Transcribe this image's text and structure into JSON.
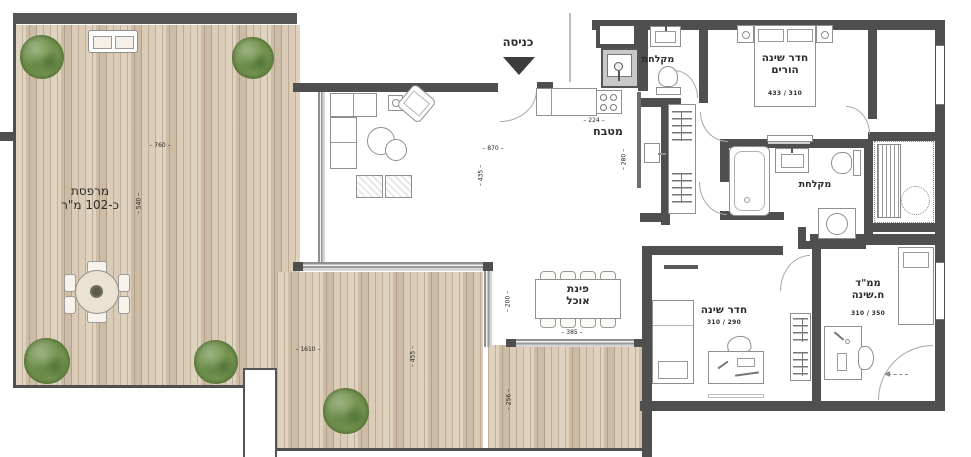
{
  "texts": {
    "entrance": "כניסה",
    "terrace_name": "מרפסת",
    "terrace_area": "כ-102 מ\"ר",
    "kitchen": "מטבח",
    "dining_line1": "פינת",
    "dining_line2": "אוכל",
    "master_line1": "חדר שינה",
    "master_line2": "הורים",
    "master_size": "433 / 310",
    "shower_entry": "מקלחת",
    "shower_master": "מקלחת",
    "bedroom2": "חדר שינה",
    "bedroom2_size": "310 / 290",
    "mamad_line1": "ממ\"ד",
    "mamad_line2": "ח.שינה",
    "mamad_size": "310 / 350"
  },
  "dims": {
    "terrace_w": "760",
    "terrace_h": "540",
    "living_w": "870",
    "living_h": "435",
    "kitchen_w": "224",
    "kitchen_h": "280",
    "deck_w": "1610",
    "deck_h": "455",
    "deck_h2": "256",
    "dining_side": "200",
    "dining_w": "385"
  },
  "colors": {
    "deck_wood": "#d9c9b3",
    "wall": "#4f4f4f",
    "tree_green": "#71914d"
  }
}
